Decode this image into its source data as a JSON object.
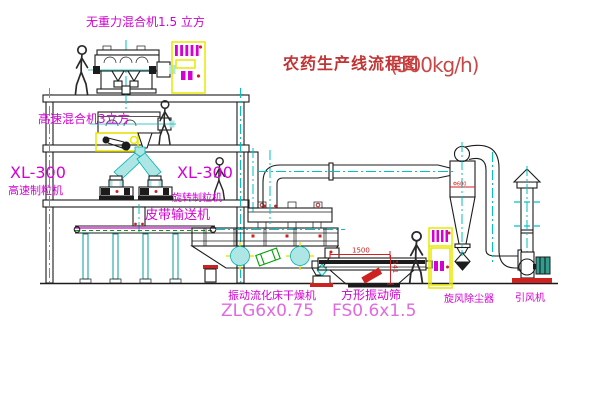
{
  "title": {
    "name": "农药生产线流程图",
    "capacity": "(500kg/h)"
  },
  "labels": {
    "gravity_mixer": "无重力混合机1.5 立方",
    "high_speed_mixer": "高速混合机3立方",
    "granulator_left_model": "XL-300",
    "granulator_left_name": "高速制粒机",
    "granulator_mid_model": "XL-300",
    "granulator_mid_name": "旋转制粒机",
    "belt_conveyor": "皮带输送机",
    "dryer_name": "振动流化床干燥机",
    "dryer_model": "ZLG6x0.75",
    "screen_name": "方形振动筛",
    "screen_model": "FS0.6x1.5",
    "cyclone_name": "旋风除尘器",
    "fan_name": "引风机"
  },
  "dimensions": {
    "screen_length": "1500",
    "screen_height": "541",
    "cyclone_diameter": "Φ600"
  },
  "colors": {
    "line": "#1c1c1c",
    "centerline_cyan": "#00c2c2",
    "label_magenta": "#d400d4",
    "model_magenta": "#e06ae0",
    "title_red": "#c23434",
    "dimension_red": "#cc2222",
    "cabinet_yellow": "#e8e800",
    "accent_green": "#00a000",
    "motor_teal": "#2f9e8f"
  }
}
